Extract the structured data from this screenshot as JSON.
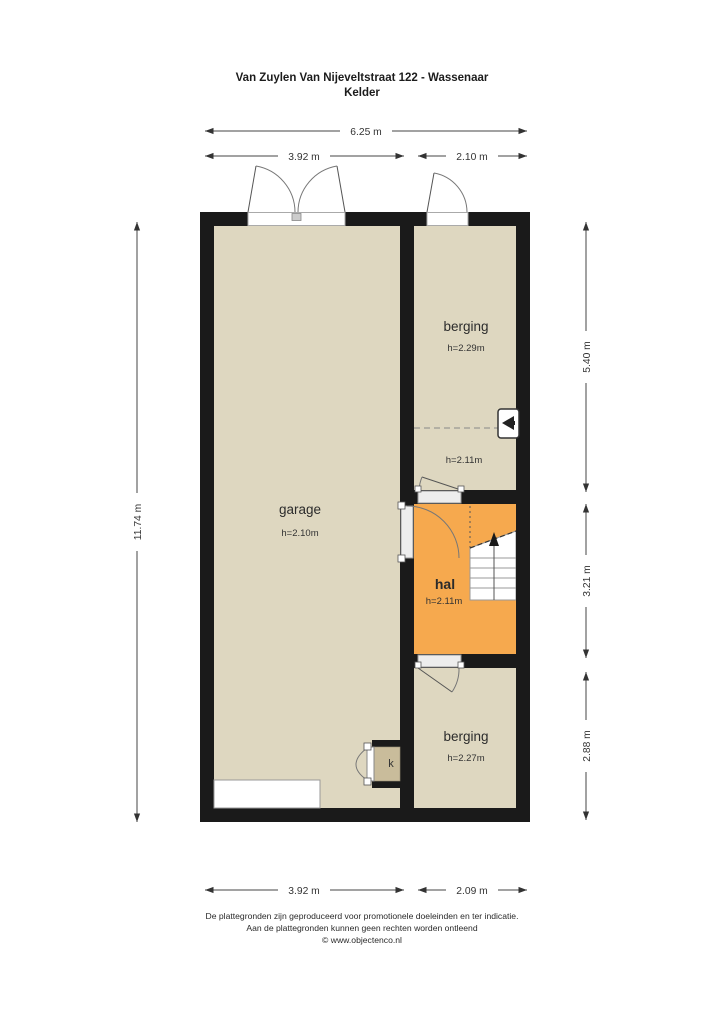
{
  "title": "Van Zuylen Van Nijeveltstraat 122 - Wassenaar",
  "subtitle": "Kelder",
  "rooms": {
    "garage": {
      "name": "garage",
      "height": "h=2.10m"
    },
    "berging_top": {
      "name": "berging",
      "height": "h=2.29m",
      "low_ceiling_height": "h=2.11m"
    },
    "hal": {
      "name": "hal",
      "height": "h=2.11m"
    },
    "berging_bottom": {
      "name": "berging",
      "height": "h=2.27m"
    },
    "closet": {
      "label": "k"
    }
  },
  "dimensions": {
    "top_total": "6.25 m",
    "top_left": "3.92 m",
    "top_right": "2.10 m",
    "left_total": "11.74 m",
    "right_top": "5.40 m",
    "right_middle": "3.21 m",
    "right_bottom": "2.88 m",
    "bottom_left": "3.92 m",
    "bottom_right": "2.09 m"
  },
  "icons": {
    "stairs_direction": "up-arrow",
    "appliance": "ventilation-unit"
  },
  "colors": {
    "wall": "#1a1a1a",
    "room_beige": "#ded7c0",
    "room_orange": "#f6a94e",
    "closet_fill": "#c9bc9b",
    "dimension_line": "#444444"
  },
  "footer": {
    "line1": "De plattegronden zijn geproduceerd voor promotionele doeleinden en ter indicatie.",
    "line2": "Aan de plattegronden kunnen geen rechten worden ontleend",
    "line3": "© www.objectenco.nl"
  }
}
